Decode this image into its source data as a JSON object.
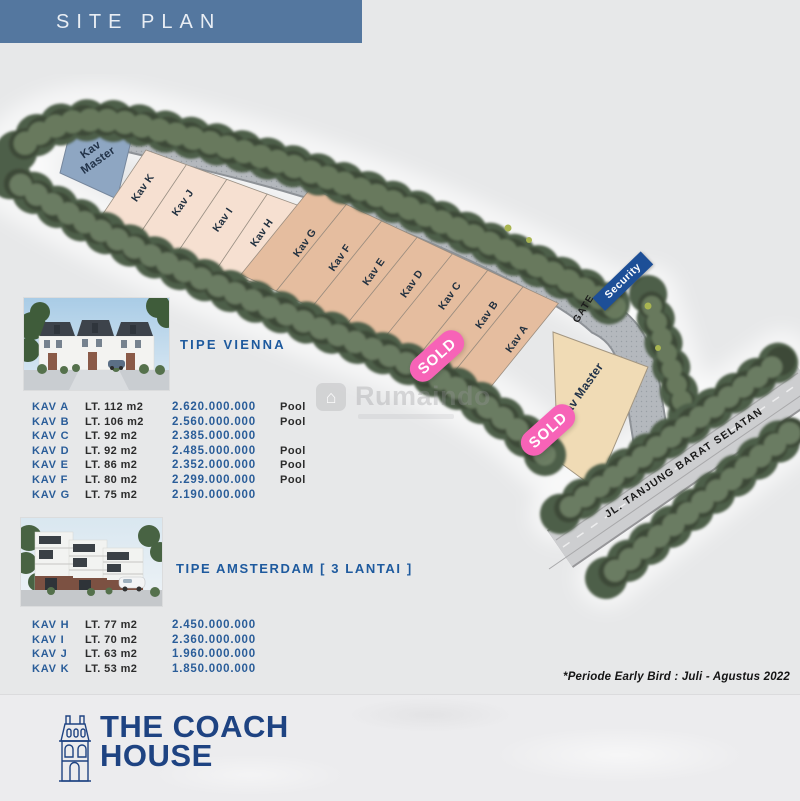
{
  "header": {
    "title": "SITE PLAN"
  },
  "site": {
    "plots": [
      {
        "label": "Kav\nMaster"
      },
      {
        "label": "Kav K"
      },
      {
        "label": "Kav J"
      },
      {
        "label": "Kav I"
      },
      {
        "label": "Kav H"
      },
      {
        "label": "Kav G"
      },
      {
        "label": "Kav F"
      },
      {
        "label": "Kav E"
      },
      {
        "label": "Kav D"
      },
      {
        "label": "Kav C"
      },
      {
        "label": "Kav B"
      },
      {
        "label": "Kav A"
      },
      {
        "label": "Kav Master"
      }
    ],
    "sold_badges": [
      {
        "label": "SOLD"
      },
      {
        "label": "SOLD"
      }
    ],
    "gate_label": "GATE",
    "security_label": "Security",
    "road_label": "JL. TANJUNG BARAT SELATAN",
    "watermark": "Rumaindo"
  },
  "vienna": {
    "title": "TIPE VIENNA",
    "rows": [
      {
        "kav": "KAV A",
        "lt": "LT. 112 m2",
        "price": "2.620.000.000",
        "pool": "Pool"
      },
      {
        "kav": "KAV B",
        "lt": "LT. 106 m2",
        "price": "2.560.000.000",
        "pool": "Pool"
      },
      {
        "kav": "KAV C",
        "lt": "LT. 92 m2",
        "price": "2.385.000.000",
        "pool": ""
      },
      {
        "kav": "KAV D",
        "lt": "LT. 92 m2",
        "price": "2.485.000.000",
        "pool": "Pool"
      },
      {
        "kav": "KAV E",
        "lt": "LT. 86 m2",
        "price": "2.352.000.000",
        "pool": "Pool"
      },
      {
        "kav": "KAV F",
        "lt": "LT. 80 m2",
        "price": "2.299.000.000",
        "pool": "Pool"
      },
      {
        "kav": "KAV G",
        "lt": "LT. 75 m2",
        "price": "2.190.000.000",
        "pool": ""
      }
    ]
  },
  "amsterdam": {
    "title": "TIPE AMSTERDAM [ 3 LANTAI ]",
    "rows": [
      {
        "kav": "KAV H",
        "lt": "LT. 77 m2",
        "price": "2.450.000.000"
      },
      {
        "kav": "KAV I",
        "lt": "LT. 70 m2",
        "price": "2.360.000.000"
      },
      {
        "kav": "KAV J",
        "lt": "LT. 63 m2",
        "price": "1.960.000.000"
      },
      {
        "kav": "KAV K",
        "lt": "LT. 53 m2",
        "price": "1.850.000.000"
      }
    ]
  },
  "note": "*Periode Early Bird : Juli - Agustus 2022",
  "footer": {
    "brand_line1": "THE COACH",
    "brand_line2": "HOUSE"
  },
  "colors": {
    "accent_blue": "#1e4382",
    "steel_header": "#54779f",
    "sold_pink": "#f763b7",
    "security_blue": "#1d4f97",
    "plot_light": "#f6e0d1",
    "plot_tan": "#e5bd9f",
    "plot_cream": "#f0dbb5",
    "plot_blue": "#8ea6c2"
  }
}
